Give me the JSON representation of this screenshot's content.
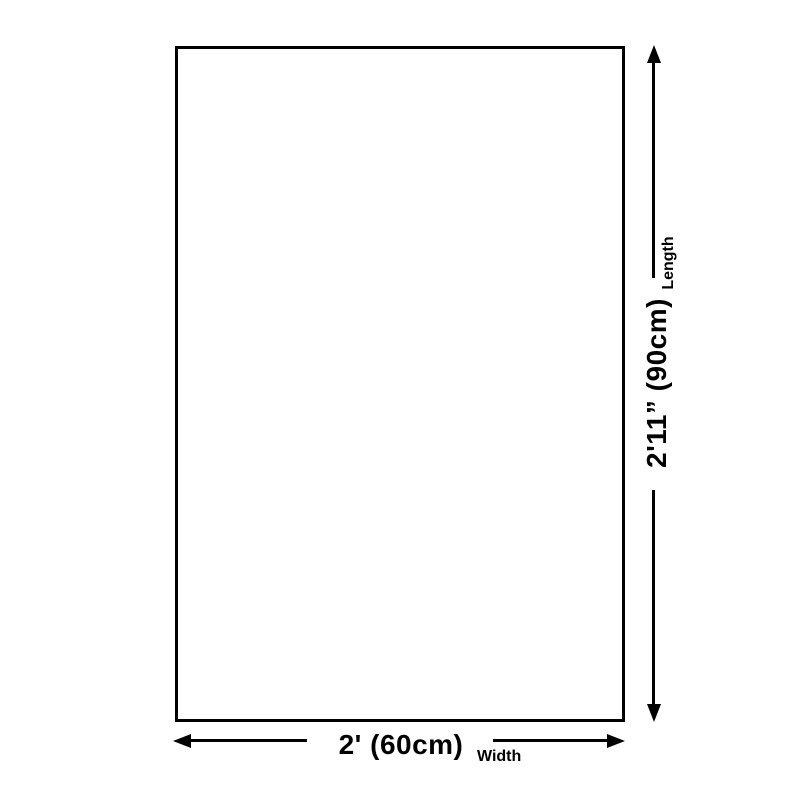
{
  "page": {
    "background": "#ffffff",
    "stroke_color": "#000000"
  },
  "diagram": {
    "width_dimension": {
      "value": "2' (60cm)",
      "label": "Width"
    },
    "length_dimension": {
      "value": "2'11” (90cm)",
      "label": "Length"
    }
  }
}
